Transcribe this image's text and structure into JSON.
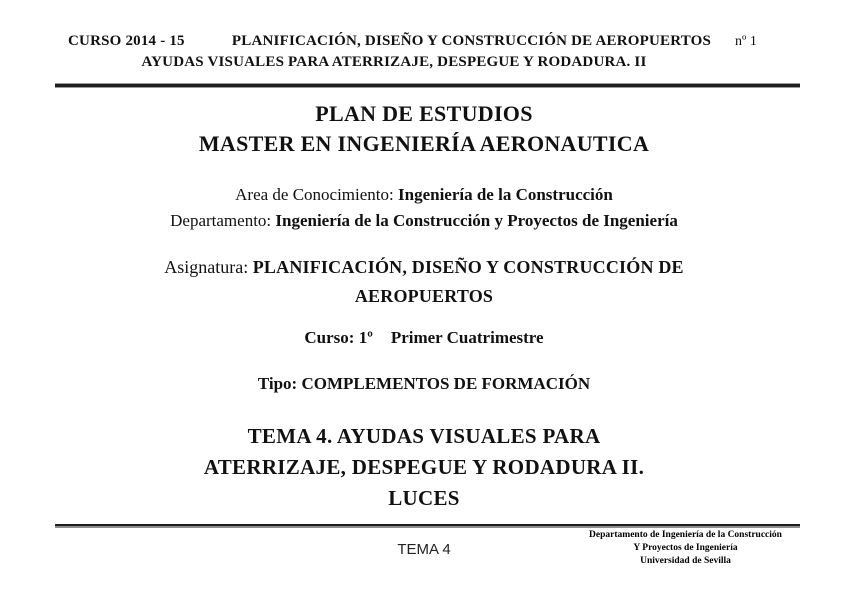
{
  "header": {
    "course": "CURSO 2014 - 15",
    "title_line1": "PLANIFICACIÓN, DISEÑO Y CONSTRUCCIÓN DE AEROPUERTOS",
    "title_line2": "AYUDAS VISUALES PARA ATERRIZAJE, DESPEGUE Y RODADURA. II",
    "page_number": "nº 1"
  },
  "body": {
    "plan_title_line1": "PLAN DE ESTUDIOS",
    "plan_title_line2": "MASTER EN INGENIERÍA AERONAUTICA",
    "area_label": "Area de Conocimiento: ",
    "area_value": "Ingeniería de la Construcción",
    "departamento_label": "Departamento: ",
    "departamento_value": "Ingeniería de la Construcción y Proyectos de Ingeniería",
    "asignatura_label": "Asignatura: ",
    "asignatura_value_line1": "PLANIFICACIÓN, DISEÑO Y CONSTRUCCIÓN DE",
    "asignatura_value_line2": "AEROPUERTOS",
    "curso_label": "Curso: 1º",
    "curso_value": "Primer Cuatrimestre",
    "tipo": "Tipo: COMPLEMENTOS DE FORMACIÓN",
    "tema_line1": "TEMA 4. AYUDAS VISUALES PARA",
    "tema_line2": "ATERRIZAJE, DESPEGUE Y RODADURA II.",
    "tema_line3": "LUCES"
  },
  "footer": {
    "center": "TEMA 4",
    "right": [
      "Departamento de Ingeniería de la Construcción",
      "Y Proyectos de Ingeniería",
      "Universidad de Sevilla"
    ]
  }
}
